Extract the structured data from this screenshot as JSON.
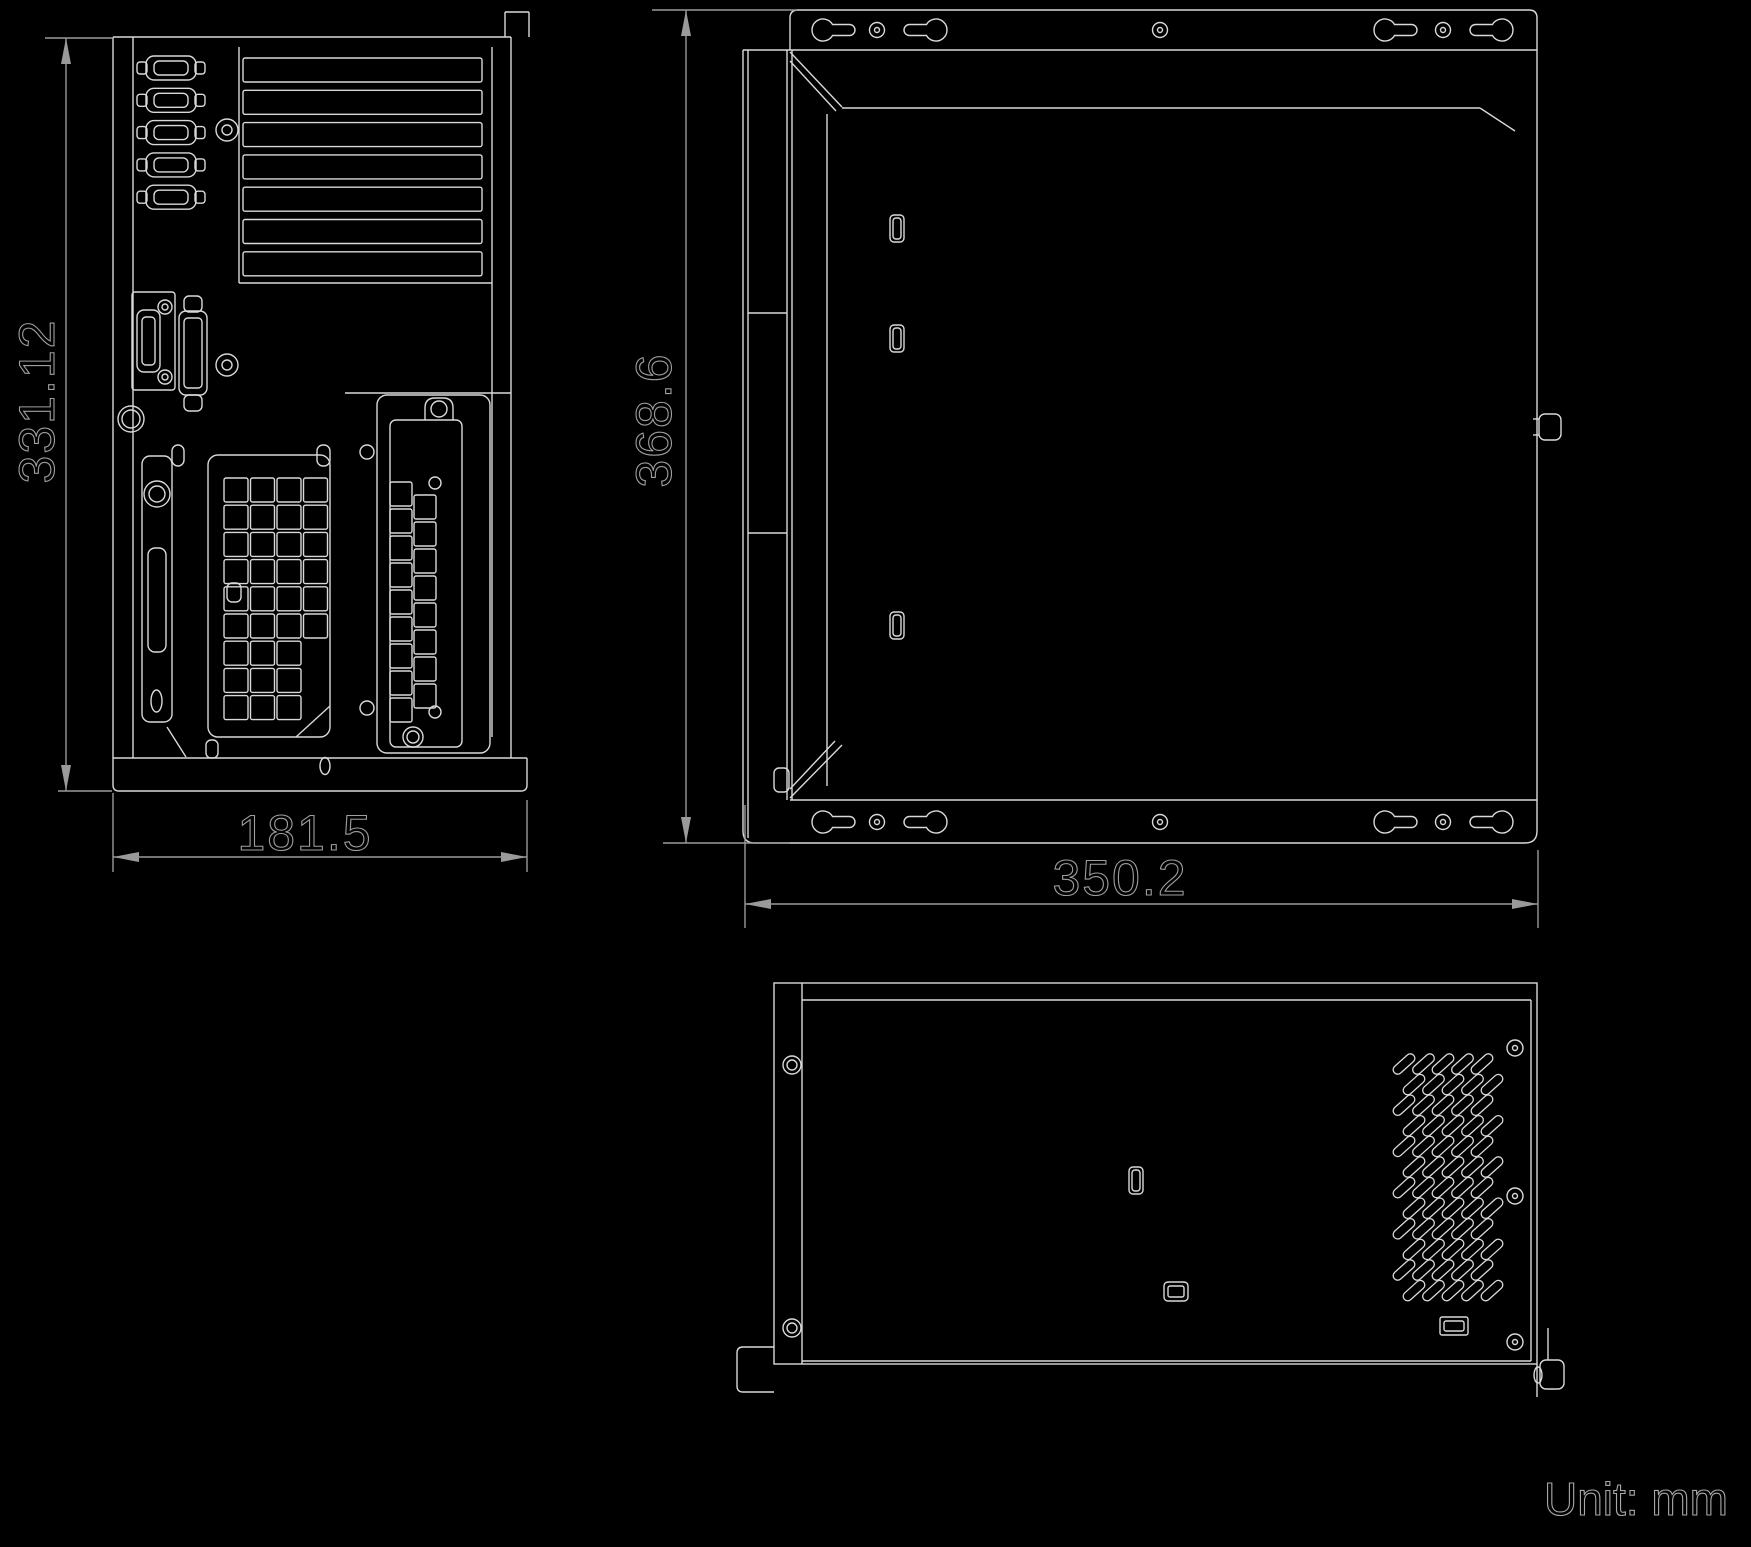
{
  "drawing": {
    "unit_label": "Unit: mm",
    "dimensions": {
      "rear_height": "331.12",
      "rear_width": "181.5",
      "side_height": "368.6",
      "side_width": "350.2"
    }
  },
  "colors": {
    "background": "#000000",
    "outline": "#d9d9d9",
    "dimension": "#9a9a9a"
  }
}
